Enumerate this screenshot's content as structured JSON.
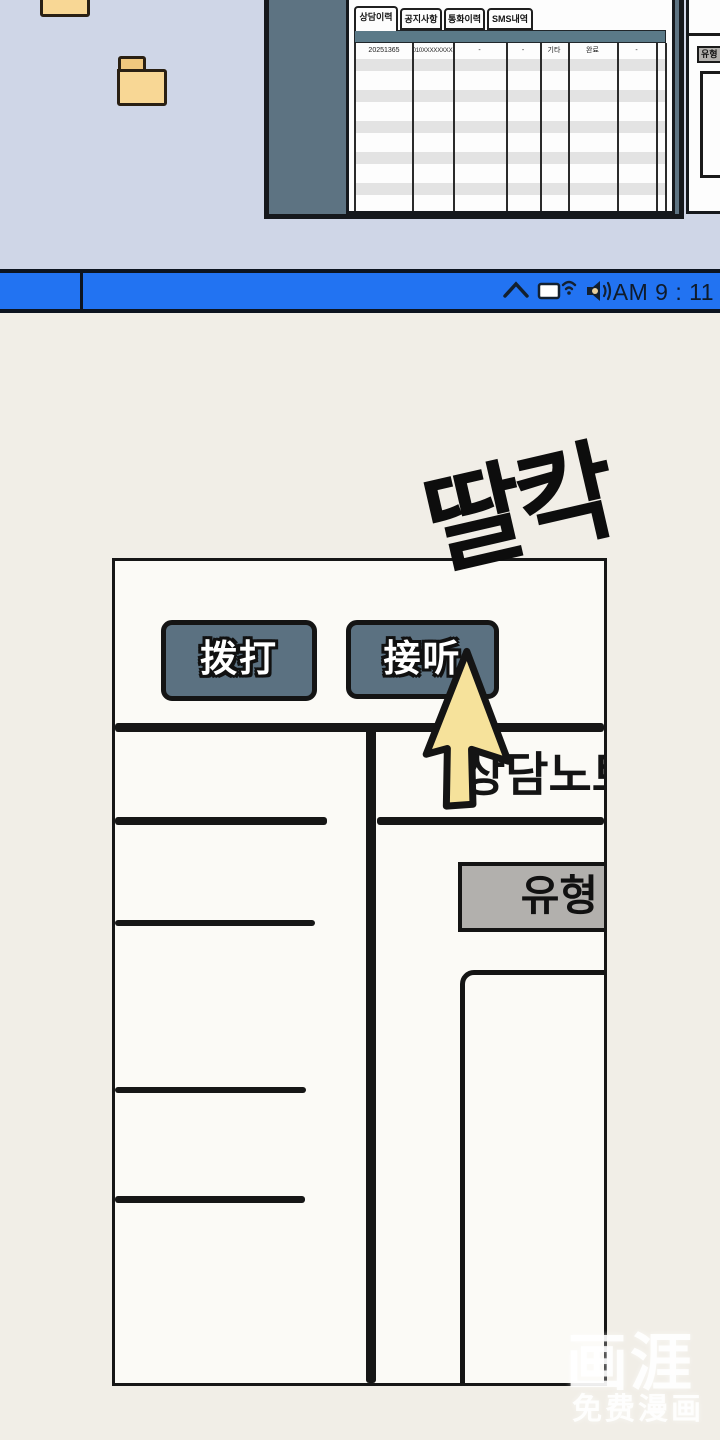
{
  "window": {
    "tabs": [
      {
        "label": "상담이력"
      },
      {
        "label": "공지사항"
      },
      {
        "label": "통화이력"
      },
      {
        "label": "SMS내역"
      }
    ],
    "active_tab": "상담이력",
    "table": {
      "row": {
        "c1": "20251365",
        "c2": "010XXXXXXXX",
        "c3": "-",
        "c4": "-",
        "c5": "기타",
        "c6": "완료",
        "c7": "-"
      }
    }
  },
  "side_panel": {
    "type_button_label": "유형"
  },
  "taskbar": {
    "clock": "AM 9 : 11",
    "icons": [
      "chevron-up",
      "display",
      "wifi",
      "speaker-volume"
    ]
  },
  "comic": {
    "sfx": "딸칵",
    "dial_button": "拨打",
    "answer_button": "接听",
    "note_title": "상담노트",
    "type_button": "유형"
  },
  "watermark": {
    "logo": "画涯",
    "tagline": "免费漫画"
  },
  "colors": {
    "taskbar_blue": "#2273f2",
    "desktop": "#cfd6e7",
    "window_frame": "#5d7382",
    "header_bar": "#5b7a88",
    "comic_button": "#5b7181",
    "cursor_yellow": "#f6e29b",
    "folder_yellow": "#f8d795",
    "type_button_gray": "#b2b0ad"
  }
}
